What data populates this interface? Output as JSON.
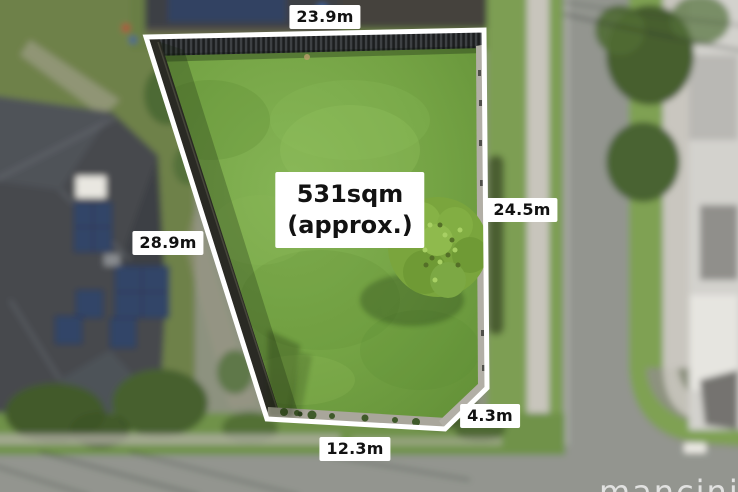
{
  "photo": {
    "description": "aerial-view-of-vacant-land-lot-with-boundary-overlay",
    "lot": {
      "area_line1": "531sqm",
      "area_line2": "(approx.)",
      "boundary_color": "#ffffff",
      "lawn_color": "#74a344",
      "fence_color": "#26282a"
    },
    "measurements": {
      "top": "23.9m",
      "left": "28.9m",
      "right": "24.5m",
      "bottom": "12.3m",
      "bottom_right": "4.3m"
    },
    "label_style": {
      "background": "#ffffff",
      "text_color": "#121212"
    },
    "watermark": {
      "text": "mancini",
      "color": "#eeeeee"
    }
  }
}
